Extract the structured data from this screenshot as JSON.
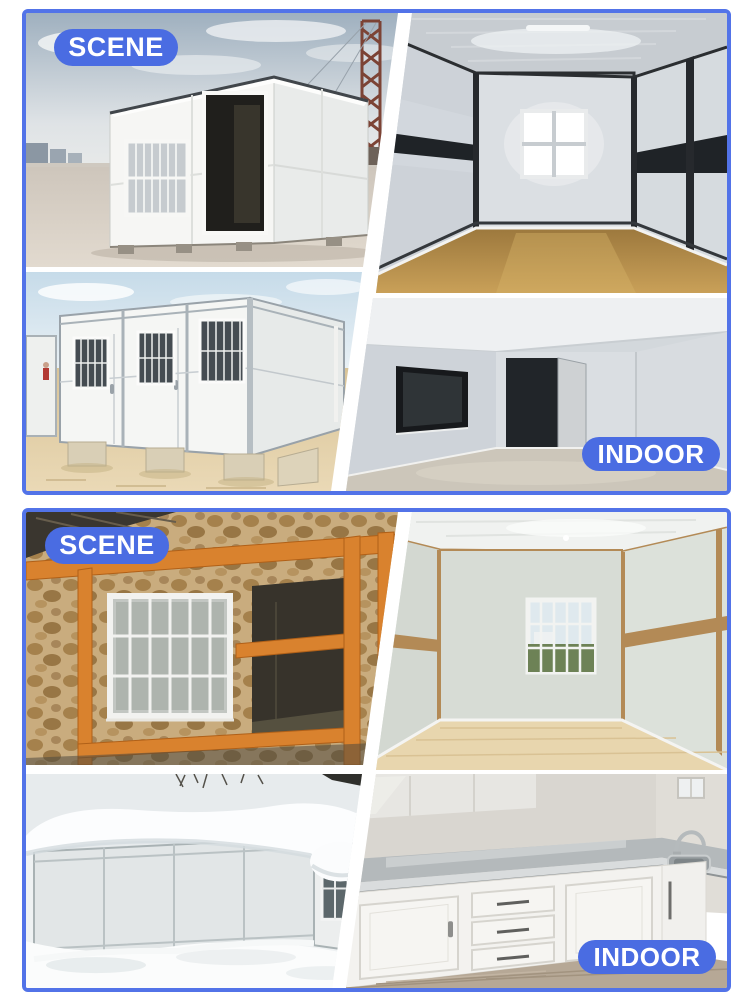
{
  "accent": {
    "badge_blue": "#4a6ce2",
    "border_blue": "#5273e8",
    "badge_text_color": "#ffffff"
  },
  "sections": [
    {
      "name": "white-folding-container",
      "scene_label": "SCENE",
      "indoor_label": "INDOOR",
      "photos": [
        {
          "name": "folding-container-exterior-scene"
        },
        {
          "name": "steel-frame-container-interior"
        },
        {
          "name": "container-house-row-exterior"
        },
        {
          "name": "empty-container-interior"
        }
      ]
    },
    {
      "name": "wood-frame-container",
      "scene_label": "SCENE",
      "indoor_label": "INDOOR",
      "photos": [
        {
          "name": "wood-frame-container-exterior-scene"
        },
        {
          "name": "wood-trim-container-interior"
        },
        {
          "name": "snow-covered-container"
        },
        {
          "name": "container-kitchen-interior"
        }
      ]
    }
  ]
}
